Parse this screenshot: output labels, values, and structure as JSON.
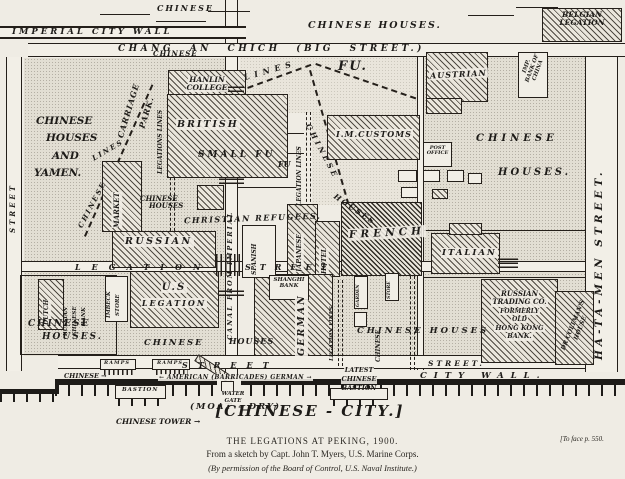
{
  "colors": {
    "ink": "#1d1b18",
    "paper": "#efece4",
    "stipple": "#e2ded3"
  },
  "m": {
    "top_chinese": "CHINESE",
    "imperial_wall": "IMPERIAL CITY WALL",
    "chang_an": "CHANG AN CHICH (BIG STREET.)",
    "chinese_houses_top": "CHINESE HOUSES.",
    "belgian": [
      "BELGIAN",
      "LEGATION"
    ],
    "chinese_small_top": "CHINESE",
    "lines_top": "LINES",
    "fu_big": "FU.",
    "fu_small": "FU",
    "austrian": "AUSTRIAN",
    "imp_bank": [
      "IMP.",
      "BANK OF",
      "CHINA"
    ],
    "hanlin": [
      "HANLIN",
      "COLLEGE"
    ],
    "british": "BRITISH",
    "carriage": "CARRIAGE",
    "park": "PARK.",
    "legations_lines_left": "LEGATIONS LINES",
    "chinese_lines_w1": "CHINESE",
    "chinese_lines_w2": "LINES",
    "street_left": "STREET",
    "yamen": [
      "CHINESE",
      "HOUSES",
      "AND",
      "YAMEN."
    ],
    "market": "MARKET",
    "chinese_houses_small": [
      "CHINESE",
      "HOUSES"
    ],
    "small_fu": "SMALL FU",
    "legation_lines_mid": "LEGATION LINES",
    "chinese_diag": "CHINESE",
    "houses_diag": "HOUSES",
    "im_customs": "I.M.CUSTOMS",
    "post_office": [
      "POST",
      "OFFICE"
    ],
    "chinese_houses_right": [
      "CHINESE",
      "HOUSES."
    ],
    "hatamen": "HA-TA-MEN STREET.",
    "christian": "CHRISTIAN REFUGEES.",
    "canal": "CANAL FROM IMPERIAL",
    "russian": "RUSSIAN",
    "us_legation": [
      "U.S",
      "LEGATION"
    ],
    "dutch": "DUTCH",
    "rcb": [
      "RUSSIAN",
      "CHINESE",
      "BANK"
    ],
    "imbeck": [
      "IMBECK",
      "STORE"
    ],
    "spanish": "SPANISH",
    "japanese": "JAPANESE",
    "hotel": "HOTEL",
    "french": "FRENCH",
    "italian": "ITALIAN",
    "shanghi": [
      "SHANGHI",
      "BANK"
    ],
    "german": "GERMAN",
    "garden": "GARDEN",
    "store": "STORE",
    "legation_lines_s": "LEGATION LINES",
    "chinese_vert": "CHINESE",
    "legation_street_w1": "LEGATION",
    "legation_street_w2": "STREET",
    "russian_trading": [
      "RUSSIAN",
      "TRADING CO.",
      "FORMERLY",
      "OLD",
      "HONG KONG",
      "BANK."
    ],
    "coltman": [
      "DR COLTMAN'S",
      "HOUSE"
    ],
    "chinese_houses_bl": [
      "CHINESE",
      "HOUSES."
    ],
    "chinese_bc": "CHINESE",
    "houses_bc": "HOUSES",
    "chinese_houses_br": "CHINESE  HOUSES",
    "ramps": "RAMPS",
    "street_bottom": "STREET",
    "street_bottom_r": "STREET.",
    "chinese_arrow": "CHINESE →",
    "bastion": "BASTION",
    "barricades": "← AMERICAN (BARRICADES) GERMAN →",
    "latest_bastion": [
      "LATEST",
      "CHINESE",
      "BASTION"
    ],
    "city_wall": "CITY  WALL.",
    "water_gate": [
      "WATER",
      "GATE"
    ],
    "moat": "(MOAT - DRY)",
    "chinese_tower": "CHINESE TOWER →",
    "chinese_city": "[CHINESE - CITY.]"
  },
  "caption": {
    "line1": "THE LEGATIONS AT PEKING, 1900.",
    "line2": "From a sketch by Capt. John T. Myers, U.S. Marine Corps.",
    "line3": "(By permission of the Board of Control, U.S. Naval Institute.)",
    "note": "[To face p. 550."
  }
}
